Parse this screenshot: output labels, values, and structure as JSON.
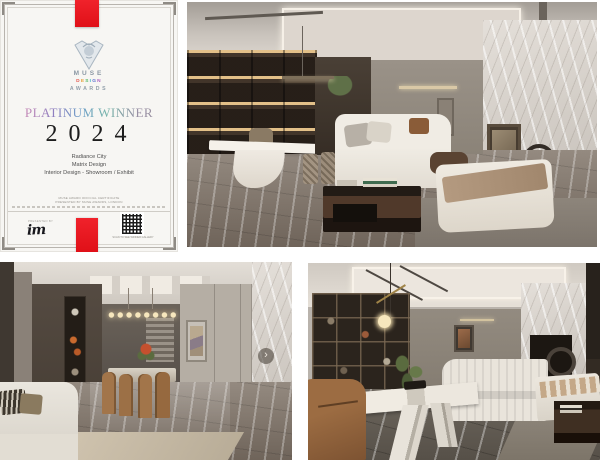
{
  "canvas": {
    "width": 600,
    "height": 460,
    "background": "#ffffff"
  },
  "certificate": {
    "name": "MUSE Design Awards platinum winner certificate",
    "paper_color": "#f7f6f3",
    "ribbon_color": "#e8141e",
    "logo": {
      "brand": "MUSE",
      "design_letters": [
        "D",
        "E",
        "S",
        "I",
        "G",
        "N"
      ],
      "design_letter_colors": [
        "#e2574c",
        "#e8a13c",
        "#58b865",
        "#3fb3c9",
        "#5b6fd0",
        "#a95fc0"
      ],
      "awards": "AWARDS"
    },
    "award_title": "PLATINUM WINNER",
    "year": "2024",
    "recipient": {
      "project": "Radiance City",
      "designer": "Matrix Design",
      "category": "Interior Design - Showroom / Exhibit"
    },
    "footnote_line1": "MUSE AWARD OFFICIAL CERTIFICATE",
    "footnote_line2": "PRESENTED BY MUSE AWARDS, LONDON",
    "presented_by_label": "PRESENTED BY",
    "presenter_logo_text": "im",
    "qr_caption": "SCAN TO SEE WINNER GALLERY"
  },
  "gallery": {
    "next_button_glyph": "›",
    "photos": [
      {
        "id": "photo-top-right",
        "description": "Marble showroom living room: lit display shelving, white sculptural desk, white sofa, dark wood coffee table with books, daybed with bronze throw, leaning artwork on marble wall"
      },
      {
        "id": "photo-bottom-left",
        "description": "Dining room: linear bulb chandelier, camel leather chairs, dark display cabinet, panelled wall with framed art, marble column, black fireplace, white sofa foreground"
      },
      {
        "id": "photo-bottom-right",
        "description": "Living room: black framed shelving, brass globe pendant, white marble table with plant, brown leather armchair, channel-tufted white sofa, marble fireplace wall with ring sculpture"
      }
    ]
  }
}
